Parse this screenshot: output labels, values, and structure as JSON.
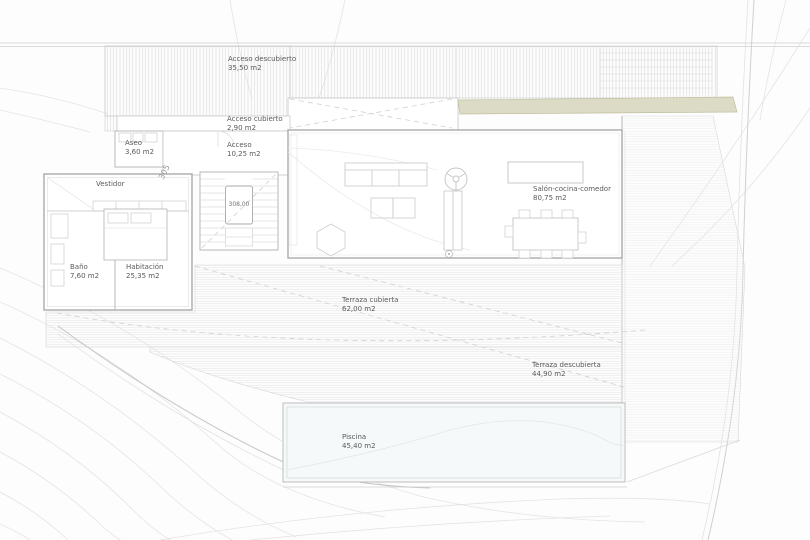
{
  "rooms": {
    "acceso_descubierto": {
      "name": "Acceso descubierto",
      "area": "35,50 m2"
    },
    "acceso_cubierto": {
      "name": "Acceso cubierto",
      "area": "2,90 m2"
    },
    "aseo": {
      "name": "Aseo",
      "area": "3,60 m2"
    },
    "acceso": {
      "name": "Acceso",
      "area": "10,25 m2"
    },
    "vestidor": {
      "name": "Vestidor"
    },
    "bano": {
      "name": "Baño",
      "area": "7,60 m2"
    },
    "habitacion": {
      "name": "Habitación",
      "area": "25,35 m2"
    },
    "salon_cocina_comedor": {
      "name": "Salón-cocina-comedor",
      "area": "80,75 m2"
    },
    "terraza_cubierta": {
      "name": "Terraza cubierta",
      "area": "62,00 m2"
    },
    "terraza_descubierta": {
      "name": "Terraza descubierta",
      "area": "44,90 m2"
    },
    "piscina": {
      "name": "Piscina",
      "area": "45,40 m2"
    }
  },
  "markers": {
    "stair_level": "308,00",
    "contour_label": "305"
  },
  "colors": {
    "planter_green": "#dcdbc6",
    "pool_tint": "#f5f9f9",
    "wall_line": "#aaaaaa",
    "thin_line": "#c9c9c9",
    "label_text": "#5a5a5a"
  }
}
